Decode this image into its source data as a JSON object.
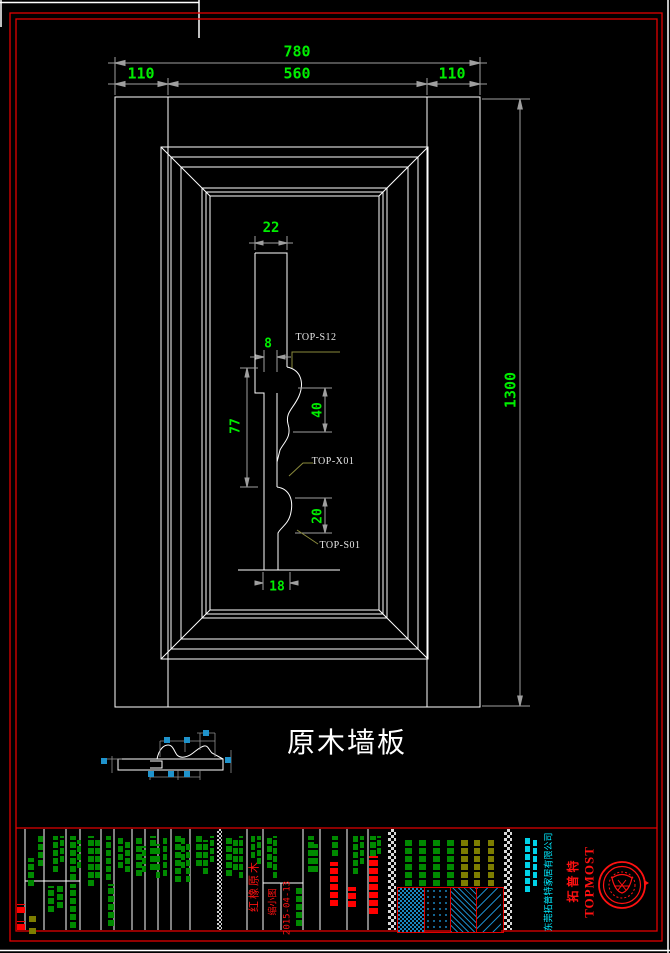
{
  "colors": {
    "background": "#000000",
    "line_white": "#ffffff",
    "dim_gray": "#9f9f9f",
    "dim_text_green": "#00ee00",
    "border_red": "#e00000",
    "leader_olive": "#8a8a3c",
    "title_block_green": "#008a00",
    "olive_bar": "#7d7d00",
    "cyan_small": "#00d2e8",
    "hatch_blue": "#1a86c0",
    "g": "#008a00",
    "r": "#ff0000",
    "o": "#7d7d00",
    "c": "#00d2e8"
  },
  "drawing": {
    "title": "原木墙板",
    "dims": {
      "overall": "780",
      "left": "110",
      "center": "560",
      "right": "110",
      "height": "1300",
      "cap_width": "22",
      "tongue": "8",
      "upper_curve": "40",
      "body": "77",
      "lower_curve": "20",
      "base": "18"
    },
    "part_labels": {
      "s12": "TOP-S12",
      "x01": "TOP-X01",
      "s01": "TOP-S01"
    }
  },
  "title_block": {
    "material": "红橡原木",
    "reduced_note": "缩小图",
    "date": "2015-04-13",
    "brand_en": "TOPMOST",
    "brand_cn": "拓普特",
    "company": "东莞拓普特家居有限公司"
  },
  "decor": {
    "bars": [
      [
        28,
        858,
        6,
        28,
        "g"
      ],
      [
        38,
        836,
        5,
        30,
        "g"
      ],
      [
        53,
        836,
        5,
        36,
        "g"
      ],
      [
        60,
        836,
        4,
        26,
        "g"
      ],
      [
        48,
        886,
        6,
        26,
        "g"
      ],
      [
        57,
        886,
        6,
        22,
        "g"
      ],
      [
        70,
        836,
        6,
        44,
        "g"
      ],
      [
        77,
        840,
        4,
        28,
        "g"
      ],
      [
        70,
        884,
        6,
        44,
        "g"
      ],
      [
        88,
        836,
        6,
        50,
        "g"
      ],
      [
        95,
        838,
        5,
        40,
        "g"
      ],
      [
        106,
        836,
        5,
        44,
        "g"
      ],
      [
        108,
        884,
        6,
        42,
        "g"
      ],
      [
        118,
        836,
        5,
        32,
        "g"
      ],
      [
        125,
        840,
        5,
        32,
        "g"
      ],
      [
        136,
        836,
        6,
        40,
        "g"
      ],
      [
        142,
        846,
        4,
        26,
        "g"
      ],
      [
        150,
        836,
        6,
        34,
        "g"
      ],
      [
        156,
        844,
        4,
        34,
        "g"
      ],
      [
        163,
        838,
        4,
        38,
        "g"
      ],
      [
        175,
        836,
        6,
        46,
        "g"
      ],
      [
        181,
        836,
        4,
        32,
        "g"
      ],
      [
        186,
        844,
        4,
        38,
        "g"
      ],
      [
        196,
        836,
        6,
        30,
        "g"
      ],
      [
        203,
        840,
        5,
        34,
        "g"
      ],
      [
        210,
        836,
        4,
        26,
        "g"
      ],
      [
        226,
        836,
        6,
        40,
        "g"
      ],
      [
        233,
        840,
        5,
        30,
        "g"
      ],
      [
        239,
        836,
        4,
        42,
        "g"
      ],
      [
        251,
        836,
        4,
        22,
        "g"
      ],
      [
        257,
        836,
        4,
        28,
        "g"
      ],
      [
        267,
        836,
        5,
        32,
        "g"
      ],
      [
        273,
        836,
        4,
        42,
        "g"
      ],
      [
        296,
        888,
        6,
        38,
        "g"
      ],
      [
        308,
        836,
        6,
        36,
        "g"
      ],
      [
        314,
        844,
        4,
        28,
        "g"
      ],
      [
        332,
        836,
        6,
        20,
        "g"
      ],
      [
        353,
        836,
        5,
        38,
        "g"
      ],
      [
        360,
        836,
        4,
        28,
        "g"
      ],
      [
        370,
        836,
        6,
        20,
        "g"
      ],
      [
        377,
        836,
        4,
        18,
        "g"
      ],
      [
        405,
        838,
        7,
        48,
        "g"
      ],
      [
        419,
        838,
        7,
        48,
        "g"
      ],
      [
        433,
        838,
        7,
        48,
        "g"
      ],
      [
        447,
        838,
        7,
        48,
        "g"
      ],
      [
        461,
        840,
        7,
        46,
        "o"
      ],
      [
        474,
        840,
        6,
        46,
        "o"
      ],
      [
        488,
        840,
        6,
        46,
        "o"
      ],
      [
        525,
        838,
        5,
        54,
        "c"
      ],
      [
        533,
        838,
        4,
        48,
        "c"
      ],
      [
        330,
        862,
        8,
        44,
        "r"
      ],
      [
        348,
        887,
        8,
        20,
        "r"
      ],
      [
        369,
        856,
        9,
        58,
        "r"
      ],
      [
        17,
        904,
        8,
        9,
        "r"
      ],
      [
        17,
        921,
        8,
        9,
        "r"
      ],
      [
        29,
        915,
        7,
        7,
        "o"
      ],
      [
        29,
        927,
        7,
        7,
        "o"
      ]
    ],
    "marks": [
      [
        164,
        737
      ],
      [
        184,
        737
      ],
      [
        203,
        730
      ],
      [
        101,
        758
      ],
      [
        225,
        757
      ],
      [
        148,
        771
      ],
      [
        168,
        771
      ],
      [
        184,
        771
      ]
    ]
  }
}
